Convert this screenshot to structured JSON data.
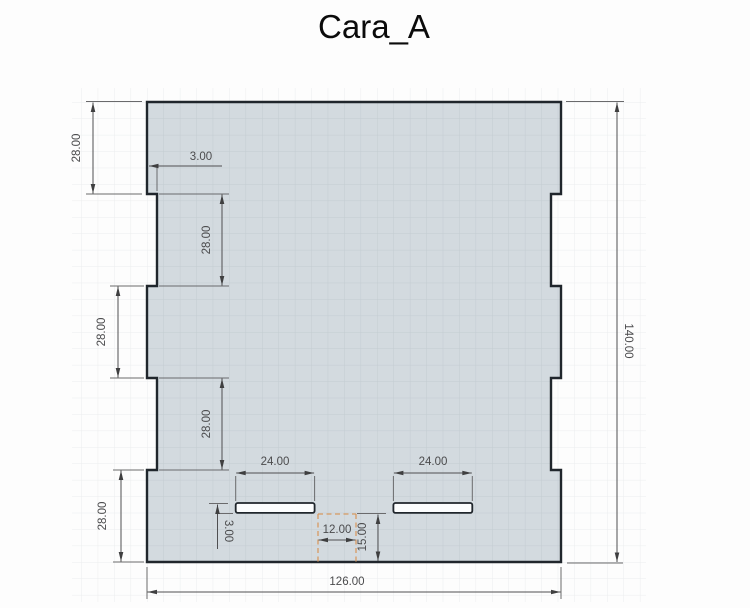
{
  "title": "Cara_A",
  "drawing": {
    "type": "cad-sketch-drawing",
    "part": {
      "overall_width_units": 126,
      "overall_height_units": 140,
      "edge_segment_units": 28,
      "tab_depth_units": 3,
      "slot_width_units": 24,
      "slot_height_units": 3,
      "slot_bottom_offset_units": 15,
      "slot_center_gap_units": 12,
      "slot_count": 2
    },
    "dimensions": {
      "left_top": "28.00",
      "tab_depth": "3.00",
      "inner_upper": "28.00",
      "left_middle": "28.00",
      "inner_lower": "28.00",
      "left_bottom": "28.00",
      "slot_left_width": "24.00",
      "slot_right_width": "24.00",
      "slot_height": "3.00",
      "slot_center_gap": "12.00",
      "slot_bottom_offset": "15.00",
      "overall_width": "126.00",
      "overall_height": "140.00"
    },
    "colors": {
      "background": "#fdfdfd",
      "grid_line_outside": "#ebedee",
      "grid_line_inside": "#c3ccd1",
      "part_fill": "#d3dadf",
      "part_outline": "#20262c",
      "slot_fill": "#fcfdfe",
      "dimension_line": "#4f4f51",
      "dimension_text": "#4b4b4d",
      "construction_dashed": "#d89a62",
      "title_text": "#0b0b0b"
    }
  }
}
